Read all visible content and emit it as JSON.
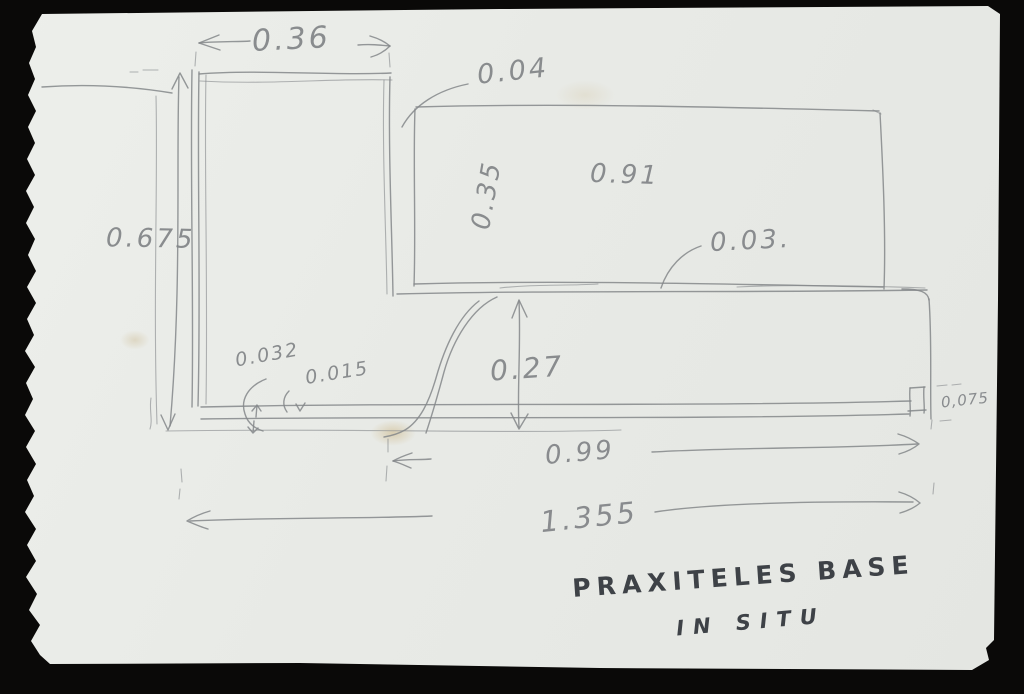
{
  "scene": {
    "background_color": "#0a0908",
    "paper_color": "#e9ebe7",
    "pencil_color": "#84878a",
    "ink_color": "#3e4247",
    "description": "Hand-drawn pencil field sketch with measurements on a torn-edge card, photographed on black"
  },
  "title": {
    "line1": "PRAXITELES BASE",
    "line2": "IN SITU"
  },
  "measurements": {
    "w036": "0.36",
    "g004": "0.04",
    "h0675": "0.675",
    "h035": "0.35",
    "w091": "0.91",
    "t003": "0.03.",
    "t0032": "0.032",
    "t0015": "0.015",
    "h027": "0.27",
    "w099": "0.99",
    "t0075": "0,075",
    "w1355": "1.355"
  }
}
